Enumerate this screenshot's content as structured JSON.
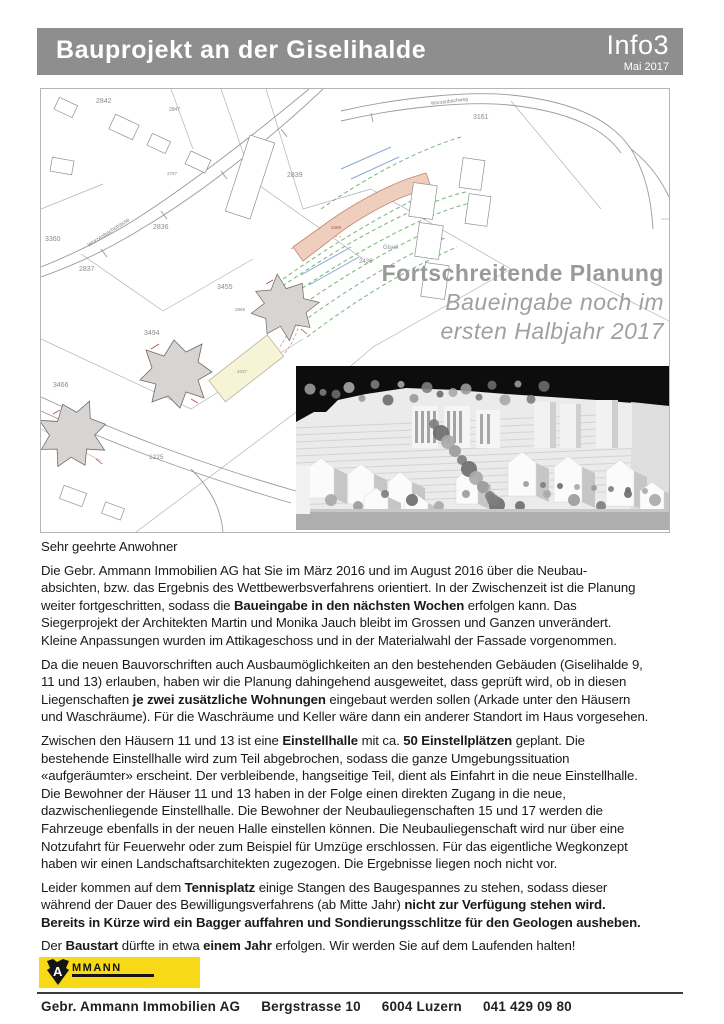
{
  "header": {
    "title": "Bauprojekt an der Giselihalde",
    "issue": "Info3",
    "date": "Mai 2017",
    "bg_color": "#8e8e8e",
    "text_color": "#ffffff"
  },
  "map": {
    "overlay": {
      "line1": "Fortschreitende Planung",
      "line2": "Baueingabe noch im",
      "line3": "ersten Halbjahr 2017",
      "color": "#9a9a9a"
    },
    "colors": {
      "planned_building": "#f0cebe",
      "highlight_building": "#f7f3d6",
      "existing_building": "#d8d4d1",
      "contour_green": "#74b574",
      "water_blue": "#8aa6d2",
      "line_gray": "#9b9b9b"
    },
    "labels": [
      {
        "t": "2842",
        "x": 55,
        "y": 14
      },
      {
        "t": "2847",
        "x": 128,
        "y": 22,
        "s": 5
      },
      {
        "t": "3161",
        "x": 432,
        "y": 30
      },
      {
        "t": "2839",
        "x": 246,
        "y": 88
      },
      {
        "t": "2836",
        "x": 112,
        "y": 140
      },
      {
        "t": "3360",
        "x": 4,
        "y": 152
      },
      {
        "t": "2837",
        "x": 38,
        "y": 182
      },
      {
        "t": "2797",
        "x": 126,
        "y": 86,
        "s": 4.5
      },
      {
        "t": "3455",
        "x": 176,
        "y": 200
      },
      {
        "t": "2436",
        "x": 318,
        "y": 174,
        "s": 6
      },
      {
        "t": "Giseli",
        "x": 342,
        "y": 160,
        "s": 6
      },
      {
        "t": "3469",
        "x": 290,
        "y": 140,
        "s": 4.5,
        "c": "#9a5a48"
      },
      {
        "t": "2868",
        "x": 194,
        "y": 222,
        "s": 4.5
      },
      {
        "t": "3494",
        "x": 103,
        "y": 246
      },
      {
        "t": "3466",
        "x": 12,
        "y": 298
      },
      {
        "t": "1225",
        "x": 108,
        "y": 370,
        "s": 6.5
      },
      {
        "t": "4037",
        "x": 196,
        "y": 284,
        "s": 4.5,
        "c": "#97907c"
      },
      {
        "t": "Würzenbachstrasse",
        "x": 48,
        "y": 158,
        "s": 5.5,
        "r": -33,
        "c": "#808080"
      },
      {
        "t": "Würzenbachweg",
        "x": 390,
        "y": 16,
        "s": 5,
        "r": -7,
        "c": "#808080"
      }
    ]
  },
  "body": {
    "greeting": "Sehr geehrte Anwohner",
    "paragraphs": [
      [
        {
          "t": "Die Gebr. Ammann Immobilien AG hat Sie im März 2016 und im August 2016 über die Neubau-"
        },
        {
          "br": true
        },
        {
          "t": "absichten, bzw. das Ergebnis des Wettbewerbsverfahrens orientiert. In der Zwischenzeit ist die Planung"
        },
        {
          "br": true
        },
        {
          "t": "weiter fortgeschritten, sodass die "
        },
        {
          "t": "Baueingabe in den nächsten Wochen",
          "b": true
        },
        {
          "t": " erfolgen kann. Das"
        },
        {
          "br": true
        },
        {
          "t": "Siegerprojekt der Architekten Martin und Monika Jauch bleibt im Grossen und Ganzen unverändert."
        },
        {
          "br": true
        },
        {
          "t": "Kleine Anpassungen wurden im Attikageschoss und in der Materialwahl der Fassade vorgenommen."
        }
      ],
      [
        {
          "t": "Da die neuen Bauvorschriften auch Ausbaumöglichkeiten an den bestehenden Gebäuden (Giselihalde 9,"
        },
        {
          "br": true
        },
        {
          "t": "11 und 13) erlauben, haben wir die Planung dahingehend ausgeweitet, dass geprüft wird, ob in diesen"
        },
        {
          "br": true
        },
        {
          "t": "Liegenschaften "
        },
        {
          "t": "je zwei zusätzliche Wohnungen",
          "b": true
        },
        {
          "t": " eingebaut werden sollen (Arkade unter den Häusern"
        },
        {
          "br": true
        },
        {
          "t": "und Waschräume). Für die Waschräume und Keller wäre dann ein anderer Standort im Haus vorgesehen."
        }
      ],
      [
        {
          "t": "Zwischen den Häusern 11 und 13 ist eine "
        },
        {
          "t": "Einstellhalle",
          "b": true
        },
        {
          "t": " mit ca. "
        },
        {
          "t": "50 Einstellplätzen",
          "b": true
        },
        {
          "t": " geplant. Die"
        },
        {
          "br": true
        },
        {
          "t": "bestehende Einstellhalle wird zum Teil abgebrochen, sodass die ganze Umgebungssituation"
        },
        {
          "br": true
        },
        {
          "t": "«aufgeräumter» erscheint. Der verbleibende, hangseitige Teil, dient als Einfahrt in die neue Einstellhalle."
        },
        {
          "br": true
        },
        {
          "t": "Die Bewohner der Häuser 11 und 13 haben in der Folge einen direkten Zugang in die neue,"
        },
        {
          "br": true
        },
        {
          "t": "dazwischenliegende Einstellhalle. Die Bewohner der Neubauliegenschaften 15 und 17 werden die"
        },
        {
          "br": true
        },
        {
          "t": "Fahrzeuge ebenfalls in der neuen Halle einstellen können. Die Neubauliegenschaft wird nur über eine"
        },
        {
          "br": true
        },
        {
          "t": "Notzufahrt für Feuerwehr oder zum Beispiel für Umzüge erschlossen. Für das eigentliche Wegkonzept"
        },
        {
          "br": true
        },
        {
          "t": "haben wir einen Landschaftsarchitekten zugezogen. Die Ergebnisse liegen noch nicht vor."
        }
      ],
      [
        {
          "t": "Leider kommen auf dem "
        },
        {
          "t": "Tennisplatz",
          "b": true
        },
        {
          "t": " einige Stangen des Baugespannes zu stehen, sodass dieser"
        },
        {
          "br": true
        },
        {
          "t": "während der Dauer des Bewilligungsverfahrens (ab Mitte Jahr)  "
        },
        {
          "t": "nicht zur Verfügung stehen wird.",
          "b": true
        },
        {
          "br": true
        },
        {
          "t": "Bereits in Kürze wird ein Bagger auffahren und Sondierungsschlitze für den Geologen ausheben.",
          "b": true
        }
      ],
      [
        {
          "t": "Der "
        },
        {
          "t": "Baustart",
          "b": true
        },
        {
          "t": " dürfte in etwa "
        },
        {
          "t": "einem Jahr",
          "b": true
        },
        {
          "t": " erfolgen.  Wir werden Sie auf dem Laufenden halten!"
        }
      ]
    ]
  },
  "logo": {
    "letter": "A",
    "name": "MMANN",
    "yellow": "#f7d917"
  },
  "footer": {
    "company": "Gebr. Ammann Immobilien AG",
    "street": "Bergstrasse 10",
    "city": "6004 Luzern",
    "phone": "041 429 09 80"
  }
}
